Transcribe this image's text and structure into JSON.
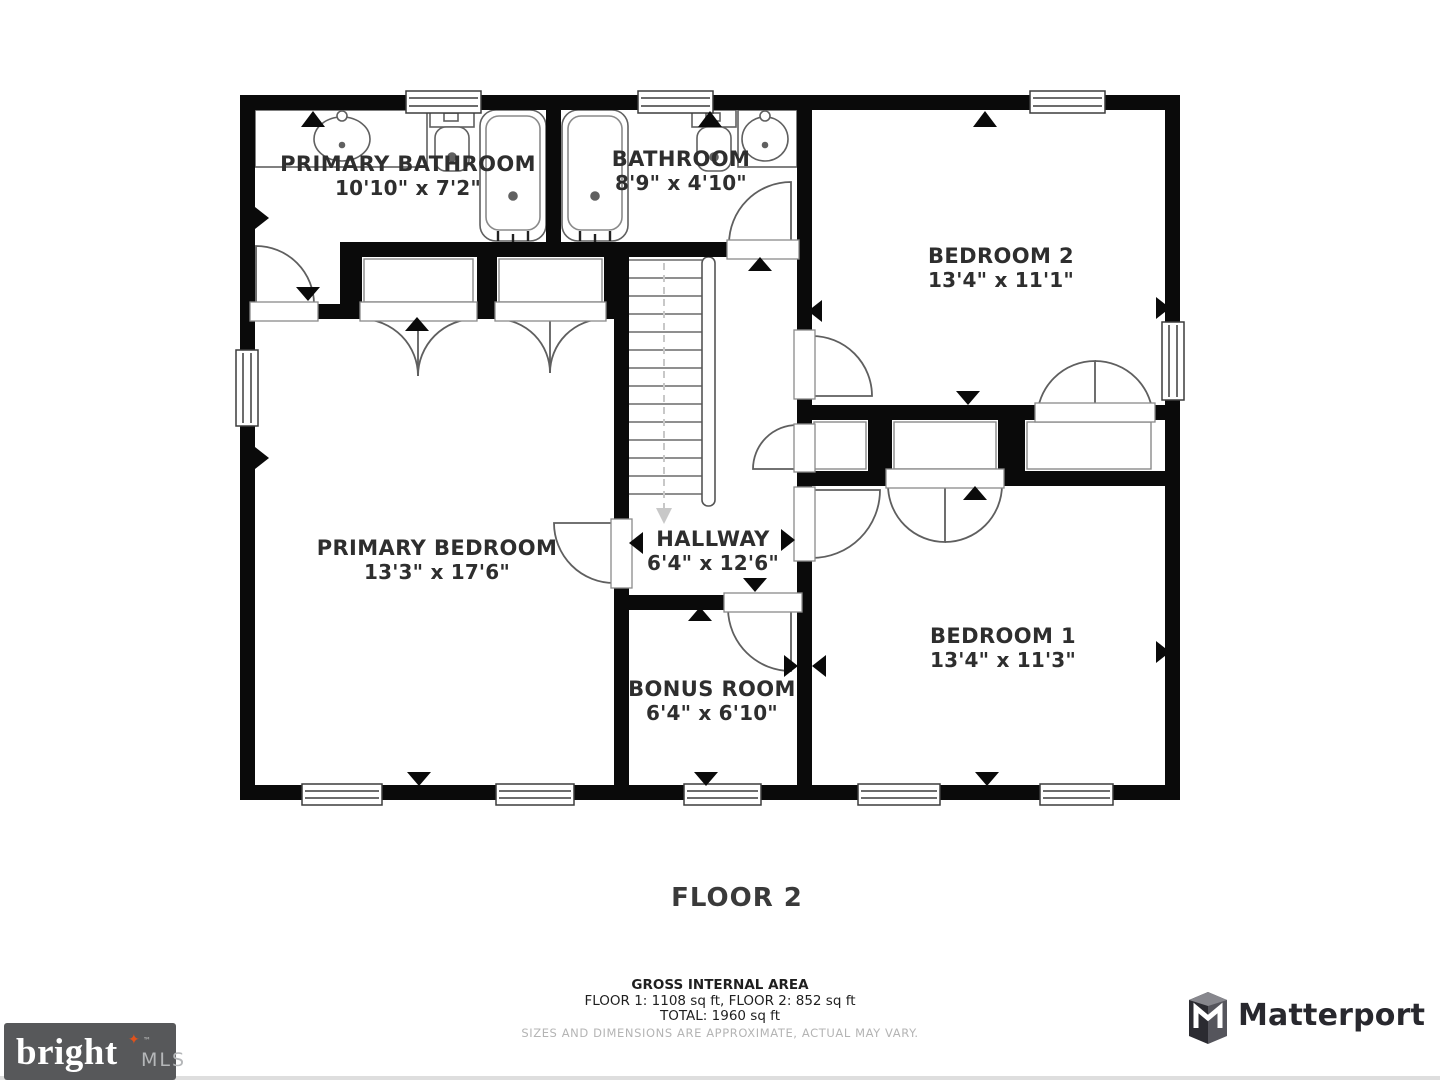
{
  "floor_plan": {
    "floor_label": "FLOOR 2",
    "rooms": [
      {
        "name": "PRIMARY BATHROOM",
        "dims": "10'10\" x 7'2\""
      },
      {
        "name": "BATHROOM",
        "dims": "8'9\" x 4'10\""
      },
      {
        "name": "BEDROOM 2",
        "dims": "13'4\" x 11'1\""
      },
      {
        "name": "PRIMARY BEDROOM",
        "dims": "13'3\" x 17'6\""
      },
      {
        "name": "HALLWAY",
        "dims": "6'4\" x 12'6\""
      },
      {
        "name": "BONUS ROOM",
        "dims": "6'4\" x 6'10\""
      },
      {
        "name": "BEDROOM 1",
        "dims": "13'4\" x 11'3\""
      }
    ],
    "area_summary": {
      "title": "GROSS INTERNAL AREA",
      "line1": "FLOOR 1: 1108 sq ft, FLOOR 2: 852 sq ft",
      "line2": "TOTAL: 1960 sq ft",
      "disclaimer": "SIZES AND DIMENSIONS ARE APPROXIMATE, ACTUAL MAY VARY."
    },
    "colors": {
      "wall": "#0a0a0a",
      "thin_line": "#5f5f5f",
      "stair_arrow": "#c8c8c8"
    }
  },
  "branding": {
    "bright_mls": {
      "word": "bright",
      "star": "✦",
      "tm": "™",
      "suffix": "MLS",
      "box_color": "#57585a",
      "star_color": "#e0521c"
    },
    "matterport": {
      "label": "Matterport",
      "text_color": "#28282e"
    }
  }
}
